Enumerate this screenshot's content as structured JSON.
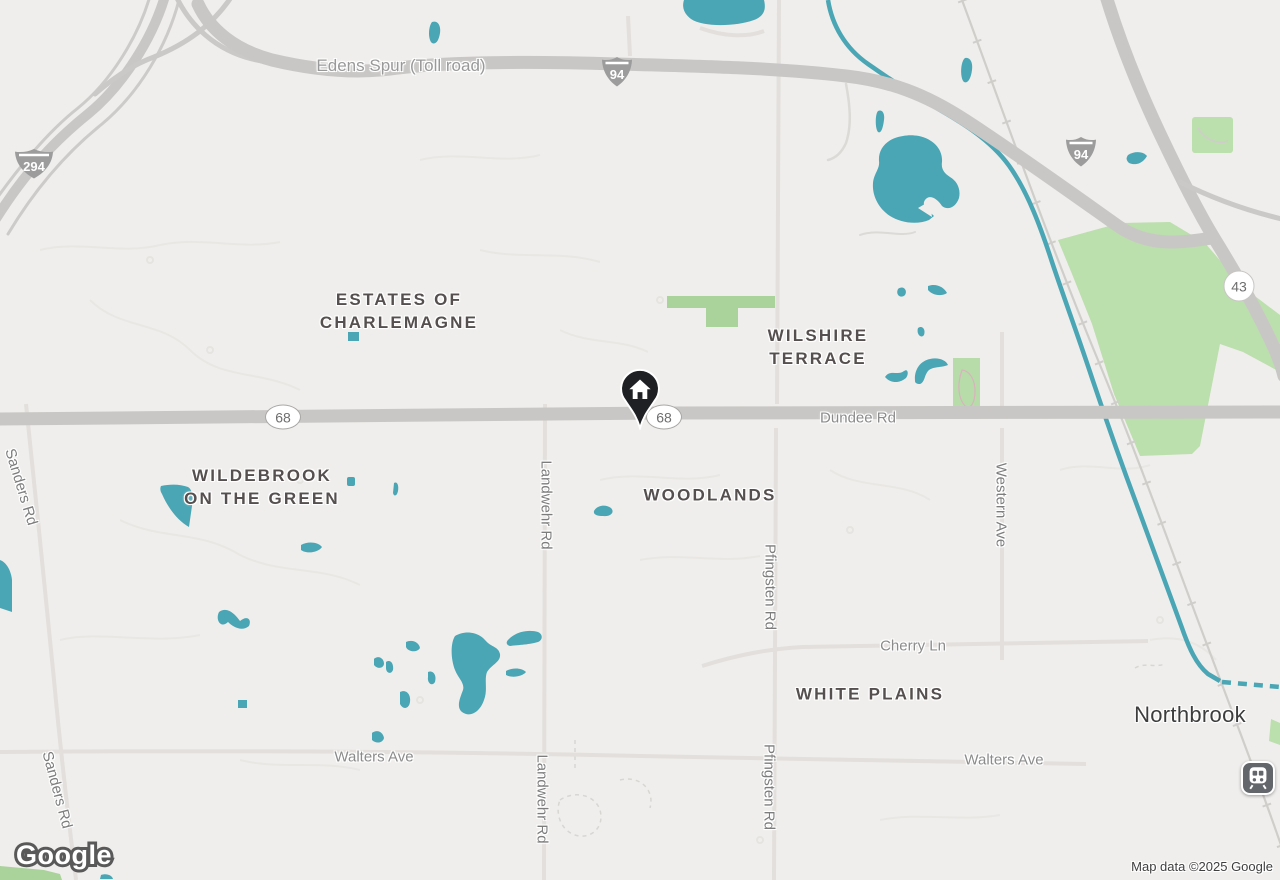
{
  "branding": {
    "google_logo": "Google"
  },
  "attribution": {
    "text": "Map data ©2025 Google"
  },
  "shields": {
    "i294": "294",
    "i94_top": "94",
    "i94_right": "94",
    "r68_west": "68",
    "r68_center": "68",
    "r43": "43"
  },
  "road_labels": {
    "edens_spur": "Edens Spur (Toll road)",
    "dundee_rd": "Dundee Rd",
    "sanders_rd_top": "Sanders Rd",
    "sanders_rd_bottom": "Sanders Rd",
    "landwehr_rd_top": "Landwehr Rd",
    "landwehr_rd_bottom": "Landwehr Rd",
    "pfingsten_rd_top": "Pfingsten Rd",
    "pfingsten_rd_bottom": "Pfingsten Rd",
    "western_ave": "Western Ave",
    "cherry_ln": "Cherry Ln",
    "walters_ave_left": "Walters Ave",
    "walters_ave_right": "Walters Ave"
  },
  "place_labels": {
    "estates_of_charlemagne": "ESTATES OF\nCHARLEMAGNE",
    "wilshire_terrace": "WILSHIRE\nTERRACE",
    "wildebrook_on_the_green": "WILDEBROOK\nON THE GREEN",
    "woodlands": "WOODLANDS",
    "white_plains": "WHITE PLAINS",
    "northbrook": "Northbrook"
  },
  "marker": {
    "type": "home-location-pin"
  },
  "station": {
    "type": "train-station"
  },
  "colors": {
    "background": "#f0eeec",
    "water": "#4aa6b4",
    "park_green": "#bcdfae",
    "strip_green": "#aad39c",
    "highway_gray": "#c9c7c5",
    "marker_black": "#1e2023",
    "place_text": "#55504f"
  }
}
